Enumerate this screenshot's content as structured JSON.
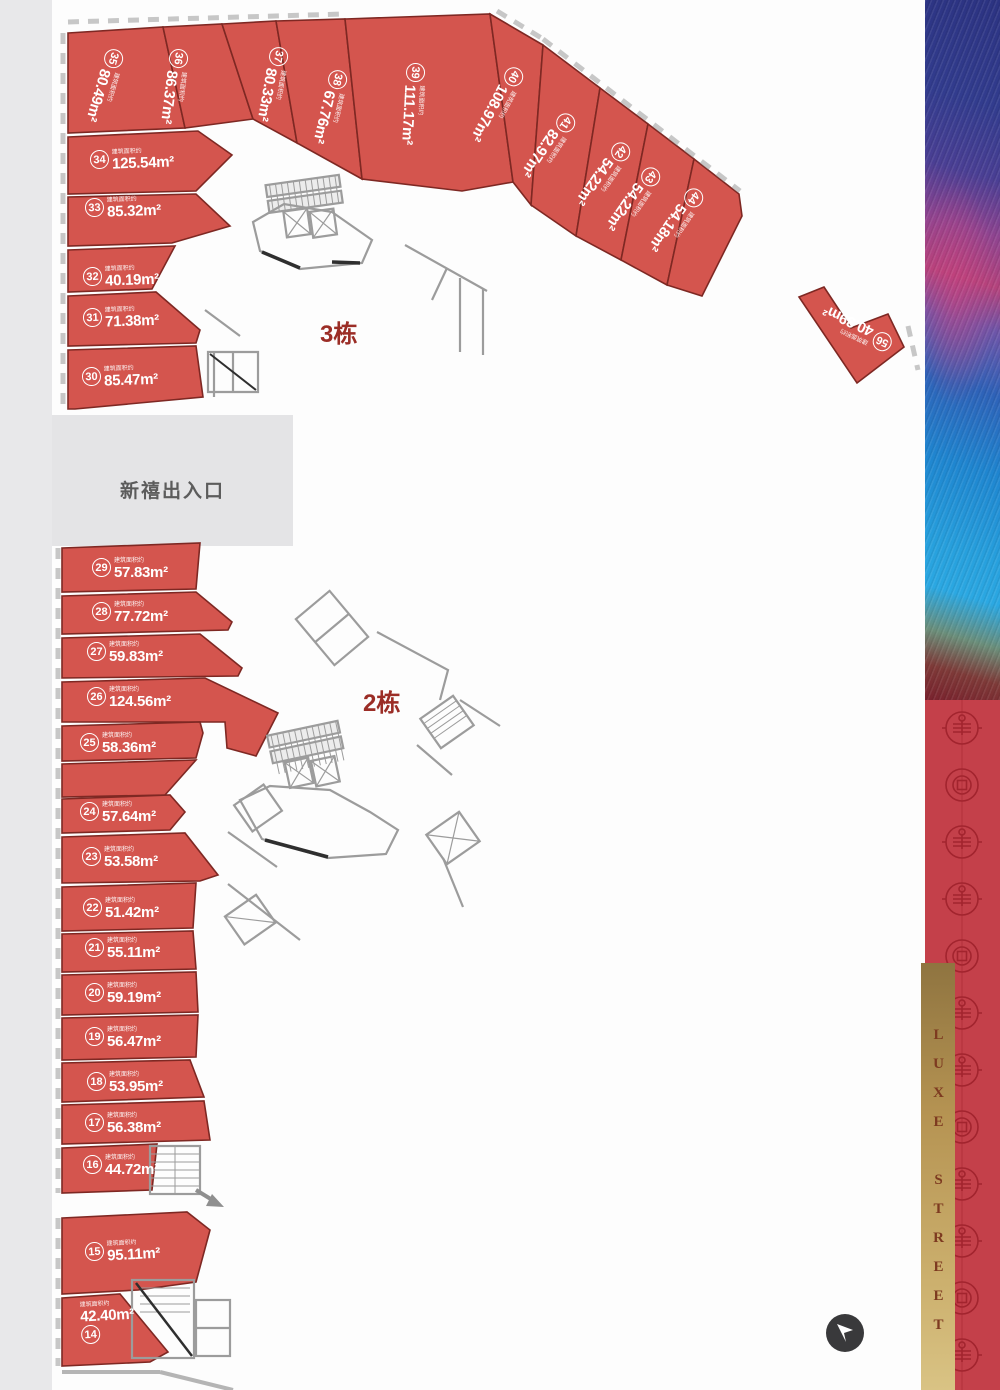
{
  "road": {
    "chars": [
      {
        "ch": "新",
        "y": 452
      },
      {
        "ch": "锐",
        "y": 676
      },
      {
        "ch": "路",
        "y": 874
      }
    ]
  },
  "entrance": {
    "label": "新禧出入口"
  },
  "buildings": {
    "b3": {
      "label": "3栋"
    },
    "b2": {
      "label": "2栋"
    }
  },
  "labels": {
    "area_prefix": "建筑面积约"
  },
  "units": [
    {
      "num": "35",
      "area": "80.49m²",
      "x": 103,
      "y": 49,
      "r": 106
    },
    {
      "num": "36",
      "area": "86.37m²",
      "x": 168,
      "y": 49,
      "r": 97
    },
    {
      "num": "37",
      "area": "80.33m²",
      "x": 268,
      "y": 47,
      "r": 100
    },
    {
      "num": "38",
      "area": "67.76m²",
      "x": 327,
      "y": 70,
      "r": 103
    },
    {
      "num": "39",
      "area": "111.17m²",
      "x": 405,
      "y": 63,
      "r": 93
    },
    {
      "num": "40",
      "area": "108.97m²",
      "x": 503,
      "y": 67,
      "r": 118
    },
    {
      "num": "41",
      "area": "82.97m²",
      "x": 555,
      "y": 113,
      "r": 124
    },
    {
      "num": "42",
      "area": "54.22m²",
      "x": 610,
      "y": 142,
      "r": 125
    },
    {
      "num": "43",
      "area": "54.22m²",
      "x": 640,
      "y": 167,
      "r": 125
    },
    {
      "num": "44",
      "area": "54.18m²",
      "x": 683,
      "y": 188,
      "r": 125
    },
    {
      "num": "34",
      "area": "125.54m²",
      "x": 90,
      "y": 150,
      "r": -2
    },
    {
      "num": "33",
      "area": "85.32m²",
      "x": 85,
      "y": 198,
      "r": -2
    },
    {
      "num": "32",
      "area": "40.19m²",
      "x": 83,
      "y": 267,
      "r": -2
    },
    {
      "num": "31",
      "area": "71.38m²",
      "x": 83,
      "y": 308,
      "r": -2
    },
    {
      "num": "30",
      "area": "85.47m²",
      "x": 82,
      "y": 367,
      "r": -2
    },
    {
      "num": "56",
      "area": "40.39m²",
      "x": 872,
      "y": 331,
      "r": 205
    },
    {
      "num": "29",
      "area": "57.83m²",
      "x": 92,
      "y": 558,
      "r": 0
    },
    {
      "num": "28",
      "area": "77.72m²",
      "x": 92,
      "y": 602,
      "r": 0
    },
    {
      "num": "27",
      "area": "59.83m²",
      "x": 87,
      "y": 642,
      "r": 0
    },
    {
      "num": "26",
      "area": "124.56m²",
      "x": 87,
      "y": 687,
      "r": 0
    },
    {
      "num": "25",
      "area": "58.36m²",
      "x": 80,
      "y": 733,
      "r": 0
    },
    {
      "num": "24",
      "area": "57.64m²",
      "x": 80,
      "y": 802,
      "r": 0
    },
    {
      "num": "23",
      "area": "53.58m²",
      "x": 82,
      "y": 847,
      "r": 0
    },
    {
      "num": "22",
      "area": "51.42m²",
      "x": 83,
      "y": 898,
      "r": 0
    },
    {
      "num": "21",
      "area": "55.11m²",
      "x": 85,
      "y": 938,
      "r": 0
    },
    {
      "num": "20",
      "area": "59.19m²",
      "x": 85,
      "y": 983,
      "r": 0
    },
    {
      "num": "19",
      "area": "56.47m²",
      "x": 85,
      "y": 1027,
      "r": 0
    },
    {
      "num": "18",
      "area": "53.95m²",
      "x": 87,
      "y": 1072,
      "r": 0
    },
    {
      "num": "17",
      "area": "56.38m²",
      "x": 85,
      "y": 1113,
      "r": 0
    },
    {
      "num": "16",
      "area": "44.72m²",
      "x": 83,
      "y": 1155,
      "r": 0
    },
    {
      "num": "15",
      "area": "95.11m²",
      "x": 85,
      "y": 1242,
      "r": -3
    },
    {
      "num": "14",
      "area": "42.40m²",
      "x": 80,
      "y": 1302,
      "r": -3,
      "cls": "below"
    }
  ],
  "dims": [
    {
      "t": "7.66",
      "x": 112,
      "y": 34,
      "r": -3
    },
    {
      "t": "7.70",
      "x": 193,
      "y": 36,
      "r": 16
    },
    {
      "t": "3.48",
      "x": 232,
      "y": 38,
      "r": 18
    },
    {
      "t": "9.70",
      "x": 283,
      "y": 38,
      "r": 20
    },
    {
      "t": "1.80",
      "x": 329,
      "y": 40,
      "r": 24
    },
    {
      "t": "5.20",
      "x": 357,
      "y": 38,
      "r": 24
    },
    {
      "t": "10.00",
      "x": 436,
      "y": 38,
      "r": -2
    },
    {
      "t": "3.43",
      "x": 489,
      "y": 42,
      "r": 55
    },
    {
      "t": "6.77",
      "x": 498,
      "y": 48,
      "r": 55
    },
    {
      "t": "6.11",
      "x": 524,
      "y": 56,
      "r": -55
    },
    {
      "t": "6.11",
      "x": 585,
      "y": 90,
      "r": -55
    },
    {
      "t": "3.98",
      "x": 633,
      "y": 123,
      "r": -55
    },
    {
      "t": "3.98",
      "x": 668,
      "y": 142,
      "r": -55
    },
    {
      "t": "3.98",
      "x": 702,
      "y": 160,
      "r": -55
    },
    {
      "t": "11.90",
      "x": 514,
      "y": 155,
      "r": 75
    },
    {
      "t": "11.90",
      "x": 570,
      "y": 182,
      "r": 62
    },
    {
      "t": "11.90",
      "x": 648,
      "y": 205,
      "r": 62
    },
    {
      "t": "11.90",
      "x": 690,
      "y": 232,
      "r": 62
    },
    {
      "t": "6.61",
      "x": 512,
      "y": 200,
      "r": -55
    },
    {
      "t": "4.31",
      "x": 566,
      "y": 228,
      "r": -55
    },
    {
      "t": "4.31",
      "x": 616,
      "y": 250,
      "r": -55
    },
    {
      "t": "4.31",
      "x": 652,
      "y": 275,
      "r": -55
    },
    {
      "t": "9.50",
      "x": 71,
      "y": 80,
      "r": -88
    },
    {
      "t": "7.81",
      "x": 112,
      "y": 126,
      "r": -3
    },
    {
      "t": "7.61",
      "x": 170,
      "y": 85,
      "r": -75
    },
    {
      "t": "11.2",
      "x": 206,
      "y": 150,
      "r": 55
    },
    {
      "t": "6.70",
      "x": 101,
      "y": 181,
      "r": -3
    },
    {
      "t": "3.85",
      "x": 175,
      "y": 200,
      "r": 55
    },
    {
      "t": "3.79",
      "x": 88,
      "y": 247,
      "r": -3
    },
    {
      "t": "4.94",
      "x": 138,
      "y": 250,
      "r": 12
    },
    {
      "t": "9.62",
      "x": 146,
      "y": 288,
      "r": 10
    },
    {
      "t": "8.87",
      "x": 126,
      "y": 334,
      "r": -3
    },
    {
      "t": "8.79",
      "x": 172,
      "y": 345,
      "r": 40
    },
    {
      "t": "11.05",
      "x": 126,
      "y": 400,
      "r": -2
    },
    {
      "t": "5.64",
      "x": 190,
      "y": 376,
      "r": 80
    },
    {
      "t": "2.90",
      "x": 806,
      "y": 288,
      "r": -24
    },
    {
      "t": "4.40",
      "x": 835,
      "y": 305,
      "r": 48
    },
    {
      "t": "8.10",
      "x": 820,
      "y": 339,
      "r": 48
    },
    {
      "t": "4.20",
      "x": 869,
      "y": 326,
      "r": -24
    },
    {
      "t": "3.70",
      "x": 894,
      "y": 329,
      "r": 55
    },
    {
      "t": "7.10",
      "x": 874,
      "y": 365,
      "r": -24
    },
    {
      "t": "11.80",
      "x": 128,
      "y": 583,
      "r": -2
    },
    {
      "t": "8.87",
      "x": 132,
      "y": 623,
      "r": -2
    },
    {
      "t": "11.26",
      "x": 130,
      "y": 678,
      "r": -2
    },
    {
      "t": "3.72",
      "x": 90,
      "y": 720,
      "r": -2
    },
    {
      "t": "11.30",
      "x": 152,
      "y": 729,
      "r": 12
    },
    {
      "t": "5.11",
      "x": 91,
      "y": 764,
      "r": -2
    },
    {
      "t": "5.00",
      "x": 152,
      "y": 768,
      "r": 10
    },
    {
      "t": "6.28",
      "x": 99,
      "y": 821,
      "r": -2
    },
    {
      "t": "7.99",
      "x": 130,
      "y": 886,
      "r": -2
    },
    {
      "t": "11.80",
      "x": 130,
      "y": 928,
      "r": -2
    },
    {
      "t": "11.80",
      "x": 130,
      "y": 969,
      "r": -2
    },
    {
      "t": "11.80",
      "x": 129,
      "y": 1013,
      "r": -2
    },
    {
      "t": "11.88",
      "x": 128,
      "y": 1060,
      "r": -2
    },
    {
      "t": "10.68",
      "x": 131,
      "y": 1104,
      "r": -2
    },
    {
      "t": "7.65",
      "x": 127,
      "y": 1144,
      "r": -2
    },
    {
      "t": "7.65",
      "x": 127,
      "y": 1184,
      "r": -2
    },
    {
      "t": "10.42",
      "x": 125,
      "y": 1218,
      "r": -2
    },
    {
      "t": "2.90",
      "x": 196,
      "y": 1222,
      "r": -28
    },
    {
      "t": "7.00",
      "x": 201,
      "y": 1254,
      "r": 70
    },
    {
      "t": "3.28",
      "x": 88,
      "y": 1284,
      "r": -4
    },
    {
      "t": "3.10",
      "x": 128,
      "y": 1286,
      "r": 45
    },
    {
      "t": "4.80",
      "x": 133,
      "y": 1328,
      "r": 42
    },
    {
      "t": "2.13",
      "x": 76,
      "y": 1358,
      "r": -4
    },
    {
      "t": "2.40",
      "x": 158,
      "y": 1342,
      "r": 70
    },
    {
      "t": "4.25",
      "x": 187,
      "y": 946,
      "r": 80
    },
    {
      "t": "4.35",
      "x": 188,
      "y": 988,
      "r": 80
    },
    {
      "t": "4.15",
      "x": 187,
      "y": 1033,
      "r": 80
    },
    {
      "t": "3.95",
      "x": 190,
      "y": 1076,
      "r": 75
    },
    {
      "t": "3.85",
      "x": 197,
      "y": 1118,
      "r": 75
    },
    {
      "t": "3.06",
      "x": 222,
      "y": 618,
      "r": 40
    }
  ],
  "sidebar": {
    "luxe_text": "LUXE STREET",
    "gold_color": "#c3a466",
    "red_band_color": "#c4404a",
    "pattern_color": "#a2242e"
  },
  "colors": {
    "unit_fill": "#d4554e",
    "unit_border": "#7e2823",
    "building_label": "#9b2d26",
    "road_bg": "#e8e8ea",
    "entrance_bg": "#e4e4e6",
    "wall_gray": "#9c9c9c",
    "nav_button": "#39393b"
  }
}
